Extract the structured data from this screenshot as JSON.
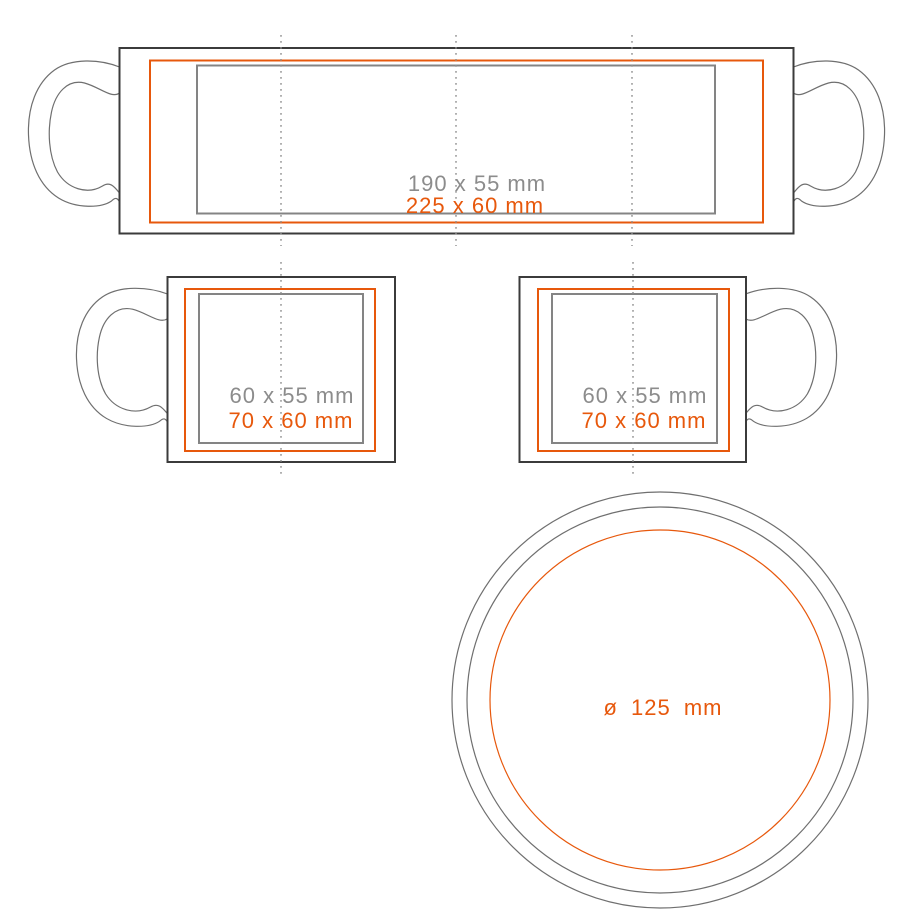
{
  "diagram_type": "mug-imprint-area-template",
  "colors": {
    "max_print_area_orange": "#e7580c",
    "safe_print_area_gray": "#848484",
    "label_gray": "#8c8c8c",
    "mug_body_outline": "#3b3b3b",
    "handle_outline": "#6f6f6f",
    "center_guide_dotted": "#8f8f8f",
    "background": "#ffffff"
  },
  "wrap_view": {
    "safe_area_label": "190 x 55 mm",
    "max_area_label": "225 x 60 mm"
  },
  "left_side_view": {
    "safe_area_label": "60 x 55 mm",
    "max_area_label": "70 x 60 mm"
  },
  "right_side_view": {
    "safe_area_label": "60 x 55 mm",
    "max_area_label": "70 x 60 mm"
  },
  "bottom_view": {
    "diameter_label": "ø 125 mm"
  }
}
